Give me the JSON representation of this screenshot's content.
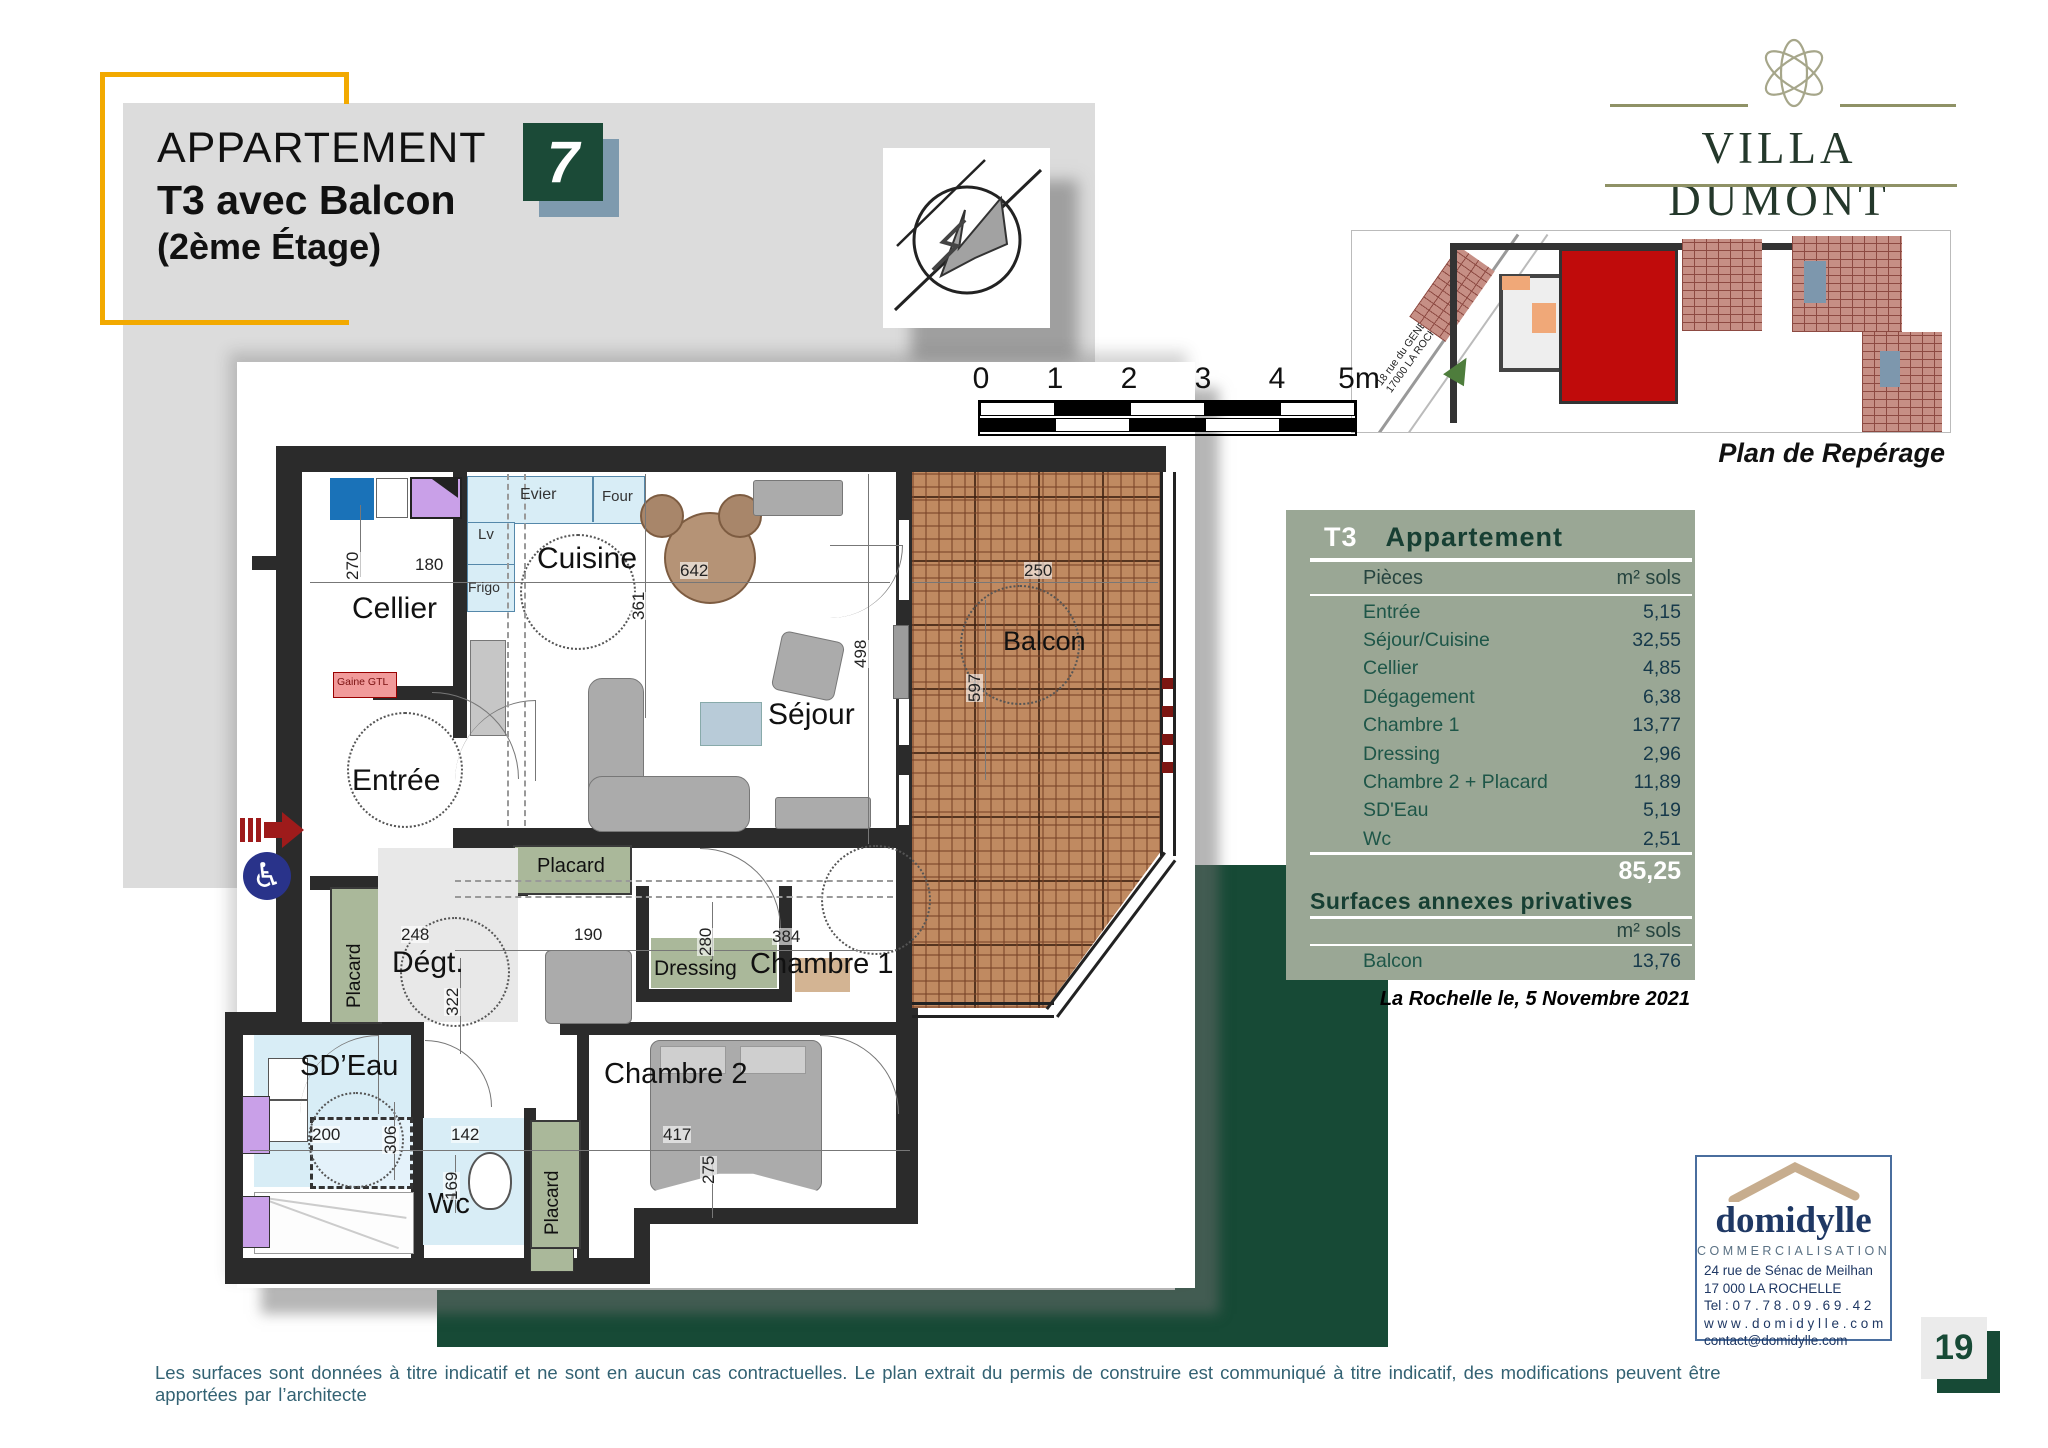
{
  "header": {
    "title_line1": "APPARTEMENT",
    "title_line2": "T3 avec Balcon",
    "title_line3": "(2ème Étage)",
    "unit_number": "7"
  },
  "brand": {
    "name": "VILLA DUMONT"
  },
  "reperage": {
    "caption": "Plan de Repérage",
    "street_line1": "18 rue du GENERAL DUMONT",
    "street_line2": "17000 LA ROCHELLE"
  },
  "colors": {
    "accent_yellow": "#f2a900",
    "dark_green": "#174a36",
    "sage_panel": "#9aa795",
    "navy": "#1f3864"
  },
  "plan": {
    "scale_ticks": [
      "0",
      "1",
      "2",
      "3",
      "4",
      "5m"
    ],
    "labels": [
      {
        "t": "Cuisine",
        "x": 537,
        "y": 544,
        "fs": 30
      },
      {
        "t": "Cellier",
        "x": 352,
        "y": 594,
        "fs": 30
      },
      {
        "t": "Entrée",
        "x": 352,
        "y": 766,
        "fs": 30
      },
      {
        "t": "Séjour",
        "x": 768,
        "y": 700,
        "fs": 30
      },
      {
        "t": "Balcon",
        "x": 1003,
        "y": 628,
        "fs": 27
      },
      {
        "t": "Dégt.",
        "x": 392,
        "y": 948,
        "fs": 30
      },
      {
        "t": "Chambre 1",
        "x": 750,
        "y": 950,
        "fs": 29
      },
      {
        "t": "Chambre 2",
        "x": 604,
        "y": 1060,
        "fs": 29
      },
      {
        "t": "SD’Eau",
        "x": 300,
        "y": 1052,
        "fs": 29
      },
      {
        "t": "Wc",
        "x": 428,
        "y": 1190,
        "fs": 29
      },
      {
        "t": "Dressing",
        "x": 654,
        "y": 958,
        "fs": 21
      },
      {
        "t": "Placard",
        "x": 537,
        "y": 856,
        "fs": 20
      },
      {
        "t": "Placard",
        "x": 345,
        "y": 1008,
        "fs": 19,
        "rot": 1
      },
      {
        "t": "Placard",
        "x": 543,
        "y": 1235,
        "fs": 19,
        "rot": 1
      },
      {
        "t": "Evier",
        "x": 520,
        "y": 487,
        "fs": 16,
        "c": "#333"
      },
      {
        "t": "Four",
        "x": 602,
        "y": 489,
        "fs": 15,
        "c": "#333"
      },
      {
        "t": "Lv",
        "x": 478,
        "y": 527,
        "fs": 15,
        "c": "#333"
      },
      {
        "t": "Frigo",
        "x": 468,
        "y": 580,
        "fs": 14,
        "c": "#333"
      },
      {
        "t": "Gaine GTL",
        "x": 337,
        "y": 677,
        "fs": 10.5,
        "c": "#7a1010"
      }
    ],
    "dims": [
      {
        "t": "180",
        "x": 415,
        "y": 556
      },
      {
        "t": "642",
        "x": 680,
        "y": 562
      },
      {
        "t": "250",
        "x": 1024,
        "y": 562
      },
      {
        "t": "248",
        "x": 401,
        "y": 926
      },
      {
        "t": "190",
        "x": 574,
        "y": 926
      },
      {
        "t": "384",
        "x": 772,
        "y": 928
      },
      {
        "t": "200",
        "x": 312,
        "y": 1126
      },
      {
        "t": "142",
        "x": 451,
        "y": 1126
      },
      {
        "t": "417",
        "x": 663,
        "y": 1126
      },
      {
        "t": "270",
        "x": 344,
        "y": 580,
        "rot": 1
      },
      {
        "t": "361",
        "x": 630,
        "y": 620,
        "rot": 1
      },
      {
        "t": "498",
        "x": 852,
        "y": 668,
        "rot": 1
      },
      {
        "t": "597",
        "x": 966,
        "y": 702,
        "rot": 1
      },
      {
        "t": "322",
        "x": 444,
        "y": 1016,
        "rot": 1
      },
      {
        "t": "280",
        "x": 697,
        "y": 956,
        "rot": 1
      },
      {
        "t": "306",
        "x": 382,
        "y": 1154,
        "rot": 1
      },
      {
        "t": "169",
        "x": 443,
        "y": 1200,
        "rot": 1
      },
      {
        "t": "275",
        "x": 700,
        "y": 1184,
        "rot": 1
      }
    ]
  },
  "table": {
    "tag": "T3",
    "title": "Appartement",
    "col_room": "Pièces",
    "col_area": "m² sols",
    "rows": [
      {
        "label": "Entrée",
        "value": "5,15"
      },
      {
        "label": "Séjour/Cuisine",
        "value": "32,55"
      },
      {
        "label": "Cellier",
        "value": "4,85"
      },
      {
        "label": "Dégagement",
        "value": "6,38"
      },
      {
        "label": "Chambre 1",
        "value": "13,77"
      },
      {
        "label": "Dressing",
        "value": "2,96"
      },
      {
        "label": "Chambre 2 + Placard",
        "value": "11,89"
      },
      {
        "label": "SD'Eau",
        "value": "5,19"
      },
      {
        "label": "Wc",
        "value": "2,51"
      }
    ],
    "total": "85,25",
    "annex_title": "Surfaces annexes privatives",
    "annex_col": "m² sols",
    "annex_rows": [
      {
        "label": "Balcon",
        "value": "13,76"
      }
    ]
  },
  "date_line": "La Rochelle  le, 5  Novembre 2021",
  "agency": {
    "name": "domidylle",
    "subtitle": "COMMERCIALISATION",
    "lines": [
      "24  rue de Sénac de Meilhan",
      "17 000    LA    ROCHELLE",
      "Tel :   0 7 . 7 8 . 0 9 . 6 9 . 4 2",
      "w w w . d o m i d y l l e . c o m",
      "contact@domidylle.com"
    ]
  },
  "page": {
    "number": "19"
  },
  "footer": {
    "disclaimer": "Les  surfaces  sont  données à  titre  indicatif et ne sont en  aucun  cas  contractuelles. Le plan extrait  du permis de  construire est  communiqué à  titre indicatif, des  modifications peuvent être apportées par l’architecte"
  }
}
